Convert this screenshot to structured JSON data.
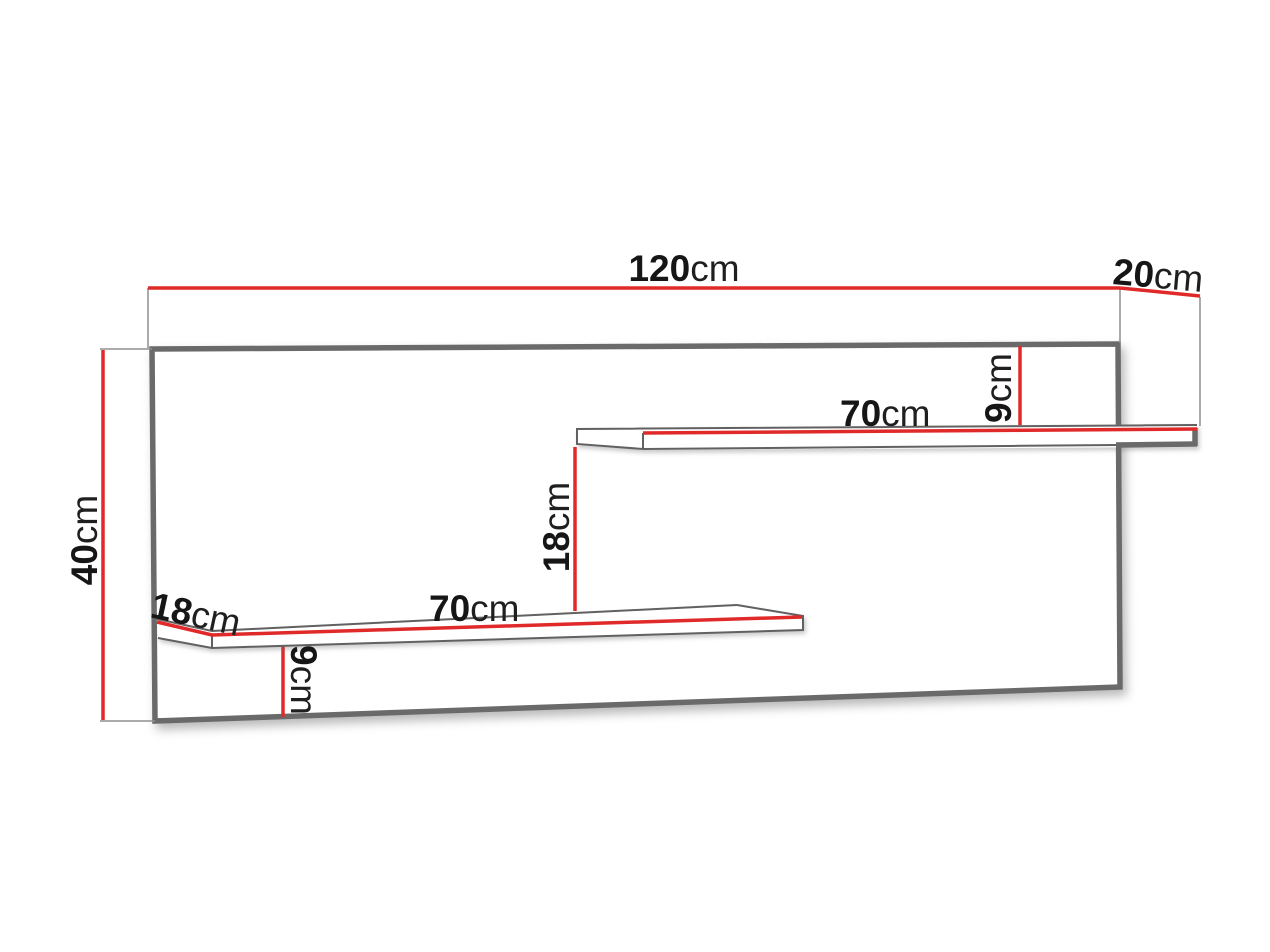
{
  "colors": {
    "dimension": "#e02a2a",
    "outline": "#6a6a6a",
    "thin_line": "#8f8f8f",
    "background": "#ffffff"
  },
  "dimensions": {
    "width": {
      "value": "120",
      "unit": "cm"
    },
    "depth": {
      "value": "20",
      "unit": "cm"
    },
    "height": {
      "value": "40",
      "unit": "cm"
    },
    "upper_shelf_length": {
      "value": "70",
      "unit": "cm"
    },
    "upper_shelf_top_offset": {
      "value": "9",
      "unit": "cm"
    },
    "shelf_vertical_gap": {
      "value": "18",
      "unit": "cm"
    },
    "lower_shelf_length": {
      "value": "70",
      "unit": "cm"
    },
    "lower_shelf_depth": {
      "value": "18",
      "unit": "cm"
    },
    "lower_shelf_bottom_offset": {
      "value": "9",
      "unit": "cm"
    }
  }
}
